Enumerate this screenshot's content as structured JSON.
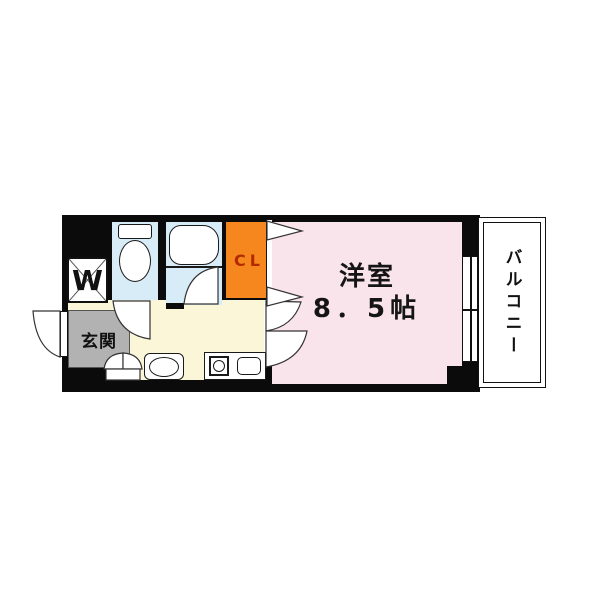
{
  "title": "apartment-floor-plan",
  "rooms": {
    "main_room": {
      "name": "洋室",
      "size": "8．5帖",
      "color": "#fae4ec"
    },
    "closet": {
      "label": "CL",
      "color": "#f6871f",
      "label_color": "#b22a00"
    },
    "entrance": {
      "label": "玄関",
      "color": "#b2b2b2"
    },
    "balcony": {
      "label": "バルコニー",
      "color": "#ffffff"
    },
    "laundry": {
      "label": "W",
      "color": "#ffffff"
    },
    "kitchen": {
      "color": "#fbf6d8"
    },
    "bathroom": {
      "color": "#d8ecf8"
    },
    "toilet": {
      "color": "#d8ecf8"
    }
  },
  "colors": {
    "walls": "#0b0b0b",
    "background": "#ffffff",
    "fixture_outline": "#1a1a1a"
  },
  "icons": {
    "toilet": "toilet-fixture-icon",
    "bathtub": "bathtub-icon",
    "stove": "stove-burner-icon",
    "sink": "kitchen-sink-icon",
    "basin": "wash-basin-icon",
    "washer": "washing-machine-icon",
    "door_arcs": "door-swing-icon",
    "folding_door": "folding-door-triangle-icon"
  }
}
